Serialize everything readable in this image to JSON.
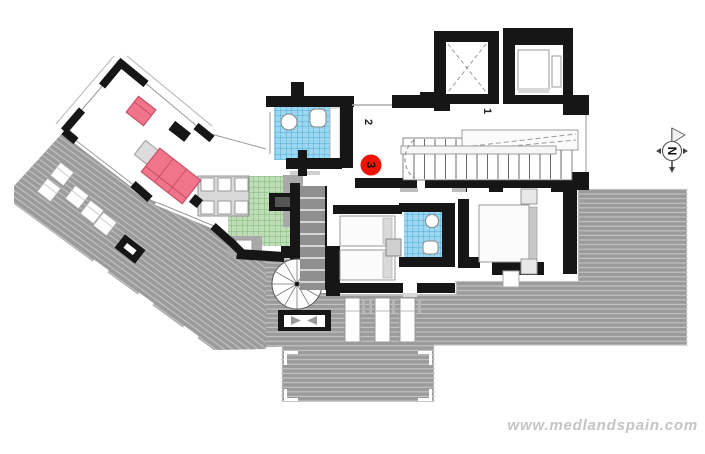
{
  "labels": {
    "zone1": "1",
    "zone2": "2",
    "zone3": "3"
  },
  "compass": {
    "letter": "N"
  },
  "watermark": {
    "text": "www.medlandspain.com"
  },
  "colors": {
    "wall": "#161616",
    "terrace_gray": "#9b9b9b",
    "terrace_line": "#c9c9c9",
    "kitchen_green": "#bedcb6",
    "kitchen_grid": "#6fae69",
    "bath_blue": "#9bd7f0",
    "bath_grid": "#3f9fcd",
    "sofa_pink": "#f0758b",
    "sofa_border": "#c94f68",
    "badge_red": "#ec1505",
    "table_gray": "#d8d8d8",
    "counter_gray": "#a9a9a9",
    "wardrobe_gray": "#8f8f8f",
    "watermark_gray": "#c4c4c4"
  }
}
